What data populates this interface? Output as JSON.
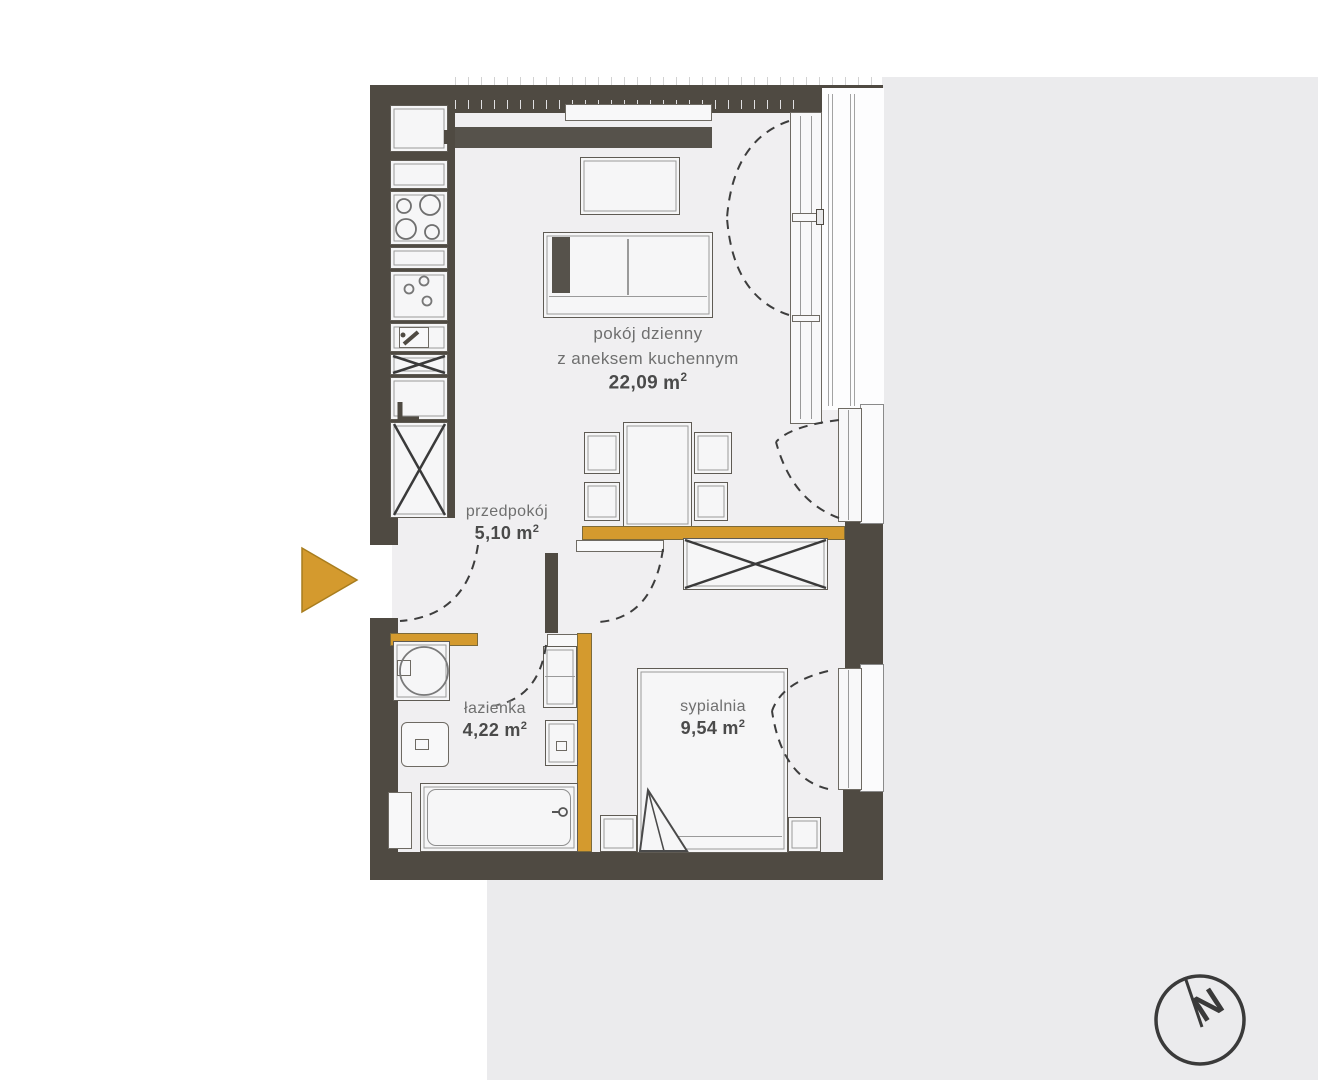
{
  "plan_title": "apartment-floor-plan",
  "colors": {
    "wall": "#4f4a42",
    "accent_partition_and_arrow": "#d49a2e",
    "floor": "#f0eff1",
    "background_panel": "#ebebed"
  },
  "rooms": {
    "living": {
      "name_line1": "pokój dzienny",
      "name_line2": "z aneksem kuchennym",
      "area": "22,09",
      "unit": "m",
      "sup": "2"
    },
    "hall": {
      "name": "przedpokój",
      "area": "5,10",
      "unit": "m",
      "sup": "2"
    },
    "bath": {
      "name": "łazienka",
      "area": "4,22",
      "unit": "m",
      "sup": "2"
    },
    "bedroom": {
      "name": "sypialnia",
      "area": "9,54",
      "unit": "m",
      "sup": "2"
    }
  },
  "compass": {
    "letter": "N"
  }
}
